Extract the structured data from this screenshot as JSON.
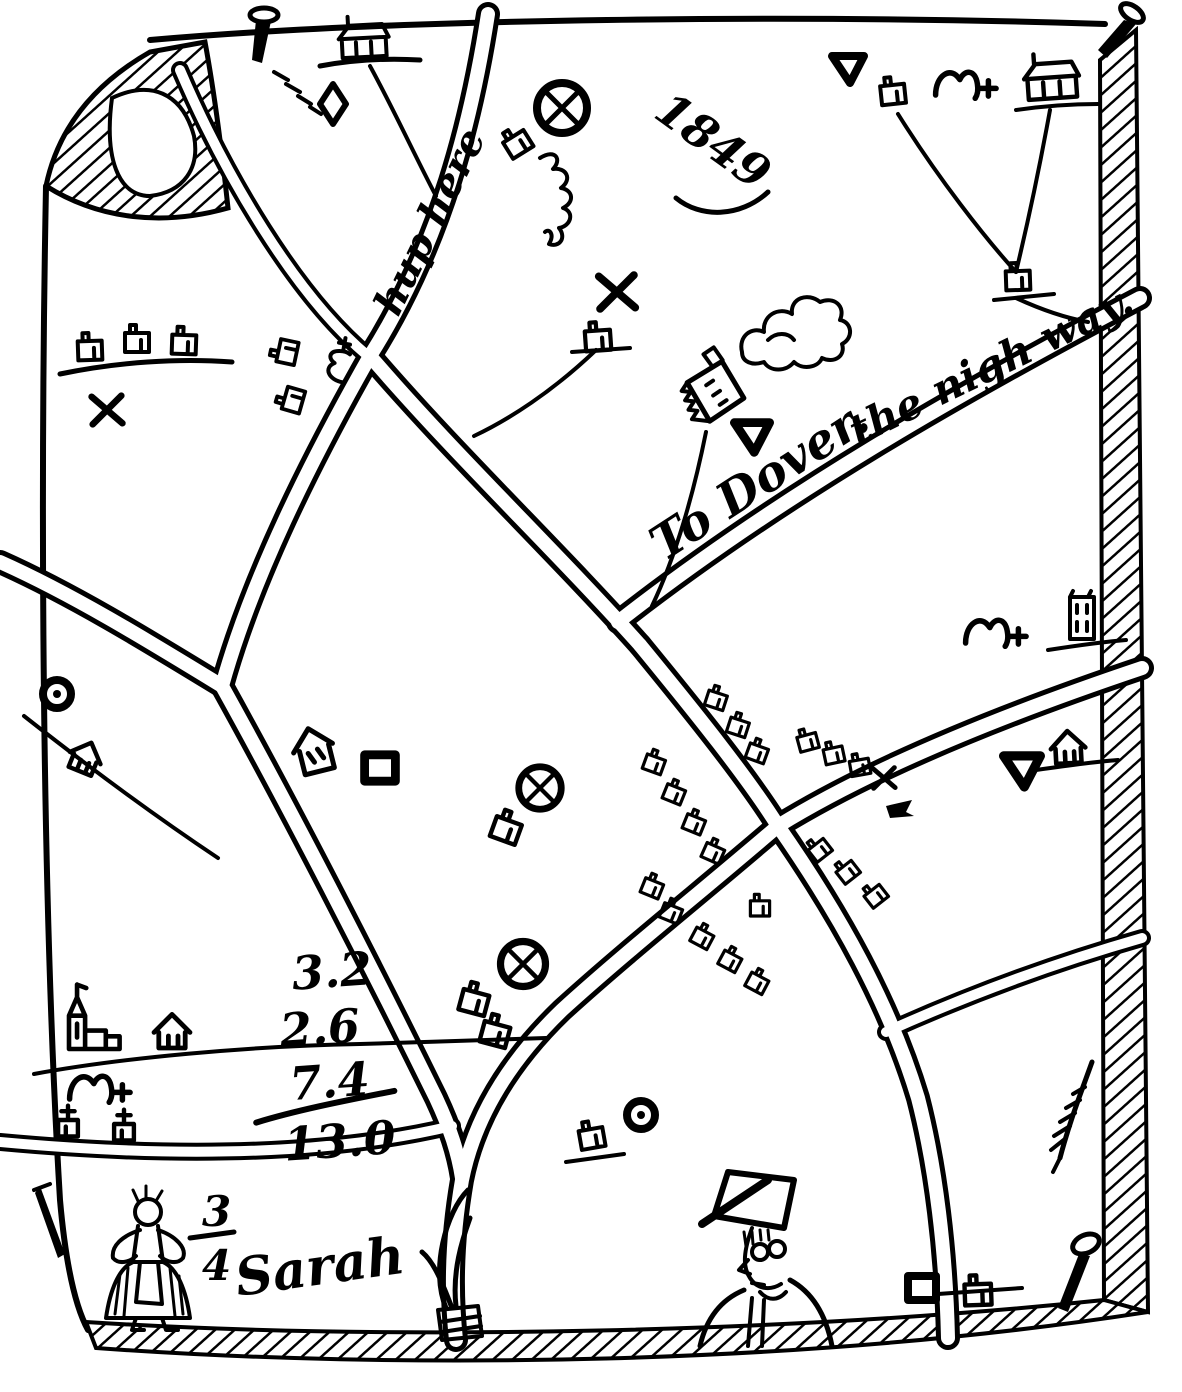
{
  "map": {
    "annotations": {
      "hup_here": "hup here",
      "year": "1849",
      "to_dover": "To Dover.",
      "nigh_way": "the nigh way.",
      "sarah": "Sarah"
    },
    "arithmetic": {
      "addends": [
        "3.2",
        "2.6",
        "7.4"
      ],
      "total": "13.0"
    },
    "fraction": {
      "numerator": "3",
      "denominator": "4"
    },
    "colors": {
      "ink": "#000000",
      "paper": "#ffffff"
    },
    "icons": [
      "nail-icon",
      "house-icon",
      "barn-icon",
      "tower-icon",
      "church-icon",
      "wheel-cross-icon",
      "ring-dot-icon",
      "diamond-icon",
      "triangle-icon",
      "x-mark-icon",
      "bridge-arch-icon",
      "square-icon",
      "factory-icon",
      "smoke-icon",
      "woman-figure-icon",
      "top-hat-man-icon",
      "sheaf-icon",
      "feather-icon",
      "cross-box-icon",
      "arrow-icon"
    ]
  }
}
